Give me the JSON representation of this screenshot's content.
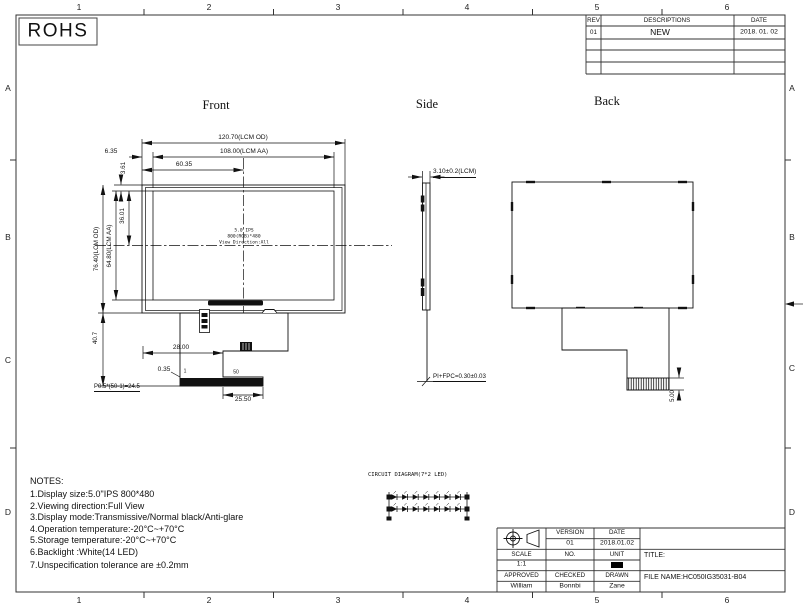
{
  "sheet": {
    "rohs": "ROHS",
    "cols": [
      "1",
      "2",
      "3",
      "4",
      "5",
      "6"
    ],
    "rows": [
      "A",
      "B",
      "C",
      "D"
    ]
  },
  "revision_table": {
    "rev_h": "REV",
    "desc_h": "DESCRIPTIONS",
    "date_h": "DATE",
    "rev": "01",
    "desc": "NEW",
    "date": "2018. 01. 02"
  },
  "views": {
    "front": {
      "title": "Front",
      "dims": {
        "od_w": "120.70(LCM OD)",
        "aa_w": "108.00(LCM AA)",
        "half_w": "60.35",
        "left_m": "6.35",
        "top_m": "3.61",
        "od_h": "76.40(LCM OD)",
        "aa_h": "64.80(LCM AA)",
        "half_h": "36.01",
        "drop": "40.7",
        "offset": "28.00",
        "pin_m": "0.35",
        "pin_first": "1",
        "pin_last": "50",
        "pitch": "P0.5*(50-1)=24.5",
        "conn_w": "25.50"
      },
      "screen": {
        "l1": "5.0 IPS",
        "l2": "800(RGB)*480",
        "l3": "View Direction:All"
      }
    },
    "side": {
      "title": "Side",
      "dims": {
        "thickness": "3.10±0.2(LCM)",
        "fpc": "PI+FPC=0.30±0.03"
      }
    },
    "back": {
      "title": "Back",
      "dims": {
        "conn_h": "5.00"
      }
    }
  },
  "notes": {
    "title": "NOTES:",
    "items": [
      "1.Display size:5.0\"IPS 800*480",
      "2.Viewing direction:Full View",
      "3.Display mode:Transmissive/Normal black/Anti-glare",
      "4.Operation temperature:-20°C~+70°C",
      "5.Storage temperature:-20°C~+70°C",
      "6.Backlight :White(14 LED)",
      "7.Unspecification tolerance are ±0.2mm"
    ]
  },
  "circuit": {
    "title": "CIRCUIT DIAGRAM(7*2 LED)"
  },
  "title_block": {
    "version_l": "VERSION",
    "date_l": "DATE",
    "version": "01",
    "date": "2018.01.02",
    "scale_l": "SCALE",
    "no_l": "NO.",
    "unit_l": "UNIT",
    "scale": "1:1",
    "unit": "mm",
    "approved_l": "APPROVED",
    "checked_l": "CHECKED",
    "drawn_l": "DRAWN",
    "approved": "William",
    "checked": "Bonnbi",
    "drawn": "Zane",
    "title_l": "TITLE:",
    "file_name": "FILE NAME:HC050IG35031-B04"
  }
}
